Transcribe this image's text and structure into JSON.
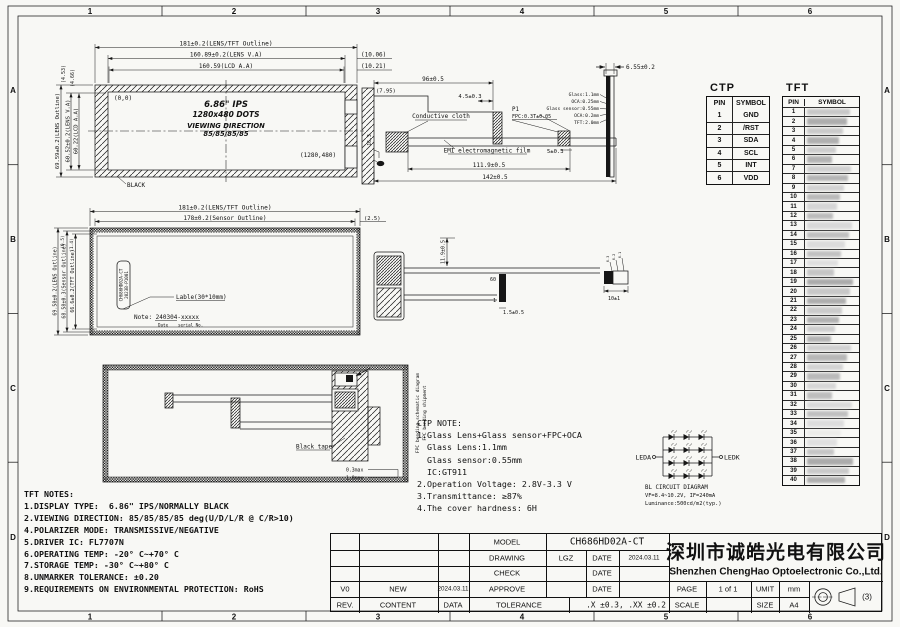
{
  "sheet": {
    "zone_cols": [
      "1",
      "2",
      "3",
      "4",
      "5",
      "6"
    ],
    "zone_rows": [
      "A",
      "B",
      "C",
      "D"
    ]
  },
  "front_view": {
    "dim_outline": "181±0.2(LENS/TFT Outline)",
    "dim_lens": "160.89±0.2(LENS V.A)",
    "dim_lcd": "160.59(LCD A.A)",
    "dim_gap1": "(10.06)",
    "dim_gap2": "(10.21)",
    "dim_h_outline": "69.59±0.2(LENS Outline)",
    "dim_h_lens": "60.52±0.2(LENS V.A)",
    "dim_h_lcd": "60.22(LCD A.A)",
    "dim_top1": "(4.53)",
    "dim_top2": "(4.66)",
    "origin": "(0,0)",
    "corner": "(1280,480)",
    "title": "6.86\" IPS",
    "dots": "1280x480 DOTS",
    "viewing": "VIEWING DIRECTION",
    "angles": "85/85/85/85",
    "black": "BLACK"
  },
  "side_view": {
    "dim_96": "96±0.5",
    "dim_45": "4.5±0.3",
    "dim_795": "(7.95)",
    "dim_163": "16.3",
    "cloth": "Conductive cloth",
    "emi": "EMI electromagnetic film",
    "p1": "P1",
    "p1_spec": "FPC:0.3T±0.05",
    "dim_5": "5±0.3",
    "dim_1119": "111.9±0.5",
    "dim_142": "142±0.5"
  },
  "edge_view": {
    "dim": "6.55±0.2",
    "stack": [
      "Glass:1.1mm",
      "OCA:0.25mm",
      "Glass sensor:0.55mm",
      "OCA:0.2mm",
      "TFT:2.0mm"
    ]
  },
  "ctp_table": {
    "title": "CTP",
    "headers": [
      "PIN",
      "SYMBOL"
    ],
    "rows": [
      [
        "1",
        "GND"
      ],
      [
        "2",
        "/RST"
      ],
      [
        "3",
        "SDA"
      ],
      [
        "4",
        "SCL"
      ],
      [
        "5",
        "INT"
      ],
      [
        "6",
        "VDD"
      ]
    ]
  },
  "tft_table": {
    "title": "TFT",
    "headers": [
      "PIN",
      "SYMBOL"
    ],
    "pin_count": 40,
    "symbols_redacted": true
  },
  "sensor_view": {
    "dim_outline": "181±0.2(LENS/TFT Outline)",
    "dim_sensor": "178±0.2(Sensor Outline)",
    "dim_25": "(2.5)",
    "dim_h_lens": "69.58±0.2(LENS Outline)",
    "dim_h_sensor": "68.58±0.3(Sensor Outline)",
    "dim_h_tft": "66.6±0.2(TFT Outline)",
    "dim_top1": "(0.5)",
    "dim_top2": "(1.4)",
    "label_line1": "CH686HD02A-CT",
    "label_line2": "2023B-P1001",
    "label_callout": "Lable(30*10mm)",
    "note": "Note: 240304-xxxxx",
    "note_date": "Date",
    "note_serial": "serial No."
  },
  "fpc_view": {
    "pin_60": "60",
    "pin_1": "1",
    "dim_v": "11.9±0.5",
    "dim_15": "1.5±0.5",
    "dim_10": "10±1",
    "stack": [
      "0.3",
      "0.2",
      "0.1"
    ]
  },
  "back_view": {
    "black_tape": "Black tape",
    "label_schematic": "FPC bending schematic diagram",
    "label_shipment": "FPC bending shipment",
    "dim_03": "0.3max",
    "dim_10": "1.0max"
  },
  "ctp_note": {
    "lines": [
      "CTP NOTE:",
      "1.Glass Lens+Glass sensor+FPC+OCA",
      "  Glass Lens:1.1mm",
      "  Glass sensor:0.55mm",
      "  IC:GT911",
      "2.Operation Voltage: 2.8V-3.3 V",
      "3.Transmittance: ≥87%",
      "4.The cover hardness: 6H"
    ]
  },
  "bl_circuit": {
    "leda": "LEDA",
    "ledk": "LEDK",
    "caption1": "BL CIRCUIT DIAGRAM",
    "caption2": "VF=8.4~10.2V, IF=240mA",
    "caption3": "Luminance:500cd/m2(typ.)"
  },
  "tft_notes": {
    "lines": [
      "TFT NOTES:",
      "1.DISPLAY TYPE:  6.86\" IPS/NORMALLY BLACK",
      "2.VIEWING DIRECTION: 85/85/85/85 deg(U/D/L/R @ C/R>10)",
      "4.POLARIZER MODE: TRANSMISSIVE/NEGATIVE",
      "5.DRIVER IC: FL7707N",
      "6.OPERATING TEMP: -20° C~+70° C",
      "7.STORAGE TEMP: -30° C~+80° C",
      "8.UNMARKER TOLERANCE: ±0.20",
      "9.REQUIREMENTS ON ENVIRONMENTAL PROTECTION: RoHS"
    ]
  },
  "title_block": {
    "model_label": "MODEL",
    "model": "CH686HD02A-CT",
    "drawing_label": "DRAWING",
    "drawing": "LGZ",
    "check_label": "CHECK",
    "approve_label": "APPROVE",
    "date_label": "DATE",
    "drawing_date": "2024.03.11",
    "tolerance_label": "TOLERANCE",
    "tolerance": ".X ±0.3, .XX ±0.2",
    "rev_label": "REV.",
    "content_label": "CONTENT",
    "data_label": "DATA",
    "rev_v0": "V0",
    "rev_content": "NEW",
    "rev_date": "2024.03.11",
    "company_cn": "深圳市诚皓光电有限公司",
    "company_en": "Shenzhen ChengHao Optoelectronic Co.,Ltd.",
    "page_label": "PAGE",
    "page": "1 of 1",
    "unit_label": "UMIT",
    "unit": "mm",
    "scale_label": "SCALE",
    "size_label": "SIZE",
    "size": "A4",
    "angle": "(3)"
  }
}
